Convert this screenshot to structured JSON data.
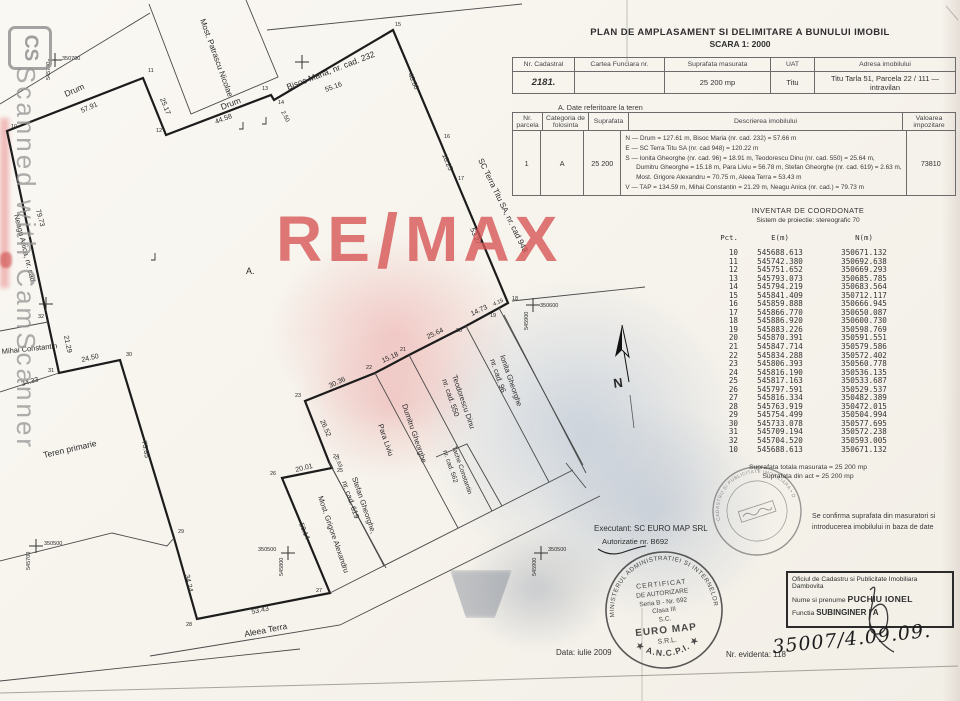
{
  "watermarks": {
    "cs_logo": "CS",
    "camscanner_text": "Scanned with CamScanner",
    "remax_re": "RE",
    "remax_slash": "/",
    "remax_max": "MAX"
  },
  "title": {
    "line1": "PLAN DE AMPLASAMENT SI DELIMITARE A BUNULUI IMOBIL",
    "line2": "SCARA 1: 2000"
  },
  "table1": {
    "headers": [
      "Nr. Cadastral",
      "Cartea Funciara nr.",
      "Suprafata masurata",
      "UAT",
      "Adresa imobilului"
    ],
    "row": {
      "nr_cadastral": "2181.",
      "cartea_funciara": "",
      "suprafata": "25 200 mp",
      "uat": "Titu",
      "adresa": "Titu Tarla 51, Parcela 22 / 111 — intravilan"
    }
  },
  "section_a": "A. Date referitoare la teren",
  "table2": {
    "headers": [
      "Nr. parcela",
      "Categoria de folosinta",
      "Suprafata",
      "Descrierea imobilului",
      "Valoarea impozitare"
    ],
    "row": {
      "nr": "1",
      "categorie": "A",
      "suprafata": "25 200",
      "descriere": [
        "N — Drum = 127.61 m, Bisoc Maria (nr. cad. 232) = 57.66 m",
        "E — SC Terra Titu SA (nr. cad 948) = 120.22 m",
        "S — Ionita Gheorghe (nr. cad. 96) = 18.91 m, Teodorescu Dinu (nr. cad. 550) = 25.64 m,",
        "      Dumitru Gheorghe = 15.18 m, Para Liviu = 56.78 m, Stefan Gheorghe (nr. cad. 619) = 2.63 m,",
        "      Most. Grigore Alexandru = 70.75 m, Aleea Terra = 53.43 m",
        "V — TAP = 134.59 m, Mihai Constantin = 21.29 m, Neagu Anica (nr. cad.) = 79.73 m"
      ],
      "valoare": "73810"
    }
  },
  "coords": {
    "title": "INVENTAR DE COORDONATE",
    "subtitle": "Sistem de proiectie: stereografic 70",
    "col_pct": "Pct.",
    "col_e": "E(m)",
    "col_n": "N(m)",
    "rows": [
      [
        "10",
        "545688.613",
        "350671.132"
      ],
      [
        "11",
        "545742.380",
        "350692.638"
      ],
      [
        "12",
        "545751.652",
        "350669.293"
      ],
      [
        "13",
        "545793.073",
        "350685.785"
      ],
      [
        "14",
        "545794.219",
        "350683.564"
      ],
      [
        "15",
        "545841.409",
        "350712.117"
      ],
      [
        "16",
        "545859.888",
        "350666.945"
      ],
      [
        "17",
        "545866.770",
        "350650.087"
      ],
      [
        "18",
        "545886.920",
        "350600.730"
      ],
      [
        "19",
        "545883.226",
        "350598.769"
      ],
      [
        "20",
        "545870.391",
        "350591.551"
      ],
      [
        "21",
        "545847.714",
        "350579.586"
      ],
      [
        "22",
        "545834.288",
        "350572.402"
      ],
      [
        "23",
        "545806.393",
        "350560.778"
      ],
      [
        "24",
        "545816.190",
        "350536.135"
      ],
      [
        "25",
        "545817.163",
        "350533.687"
      ],
      [
        "26",
        "545797.591",
        "350529.537"
      ],
      [
        "27",
        "545816.334",
        "350482.389"
      ],
      [
        "28",
        "545763.919",
        "350472.015"
      ],
      [
        "29",
        "545754.499",
        "350504.994"
      ],
      [
        "30",
        "545733.078",
        "350577.695"
      ],
      [
        "31",
        "545709.194",
        "350572.238"
      ],
      [
        "32",
        "545704.520",
        "350593.005"
      ],
      [
        "10",
        "545688.613",
        "350671.132"
      ]
    ],
    "total1": "Suprafata totala masurata = 25 200 mp",
    "total2": "Suprafata din act = 25 200 mp"
  },
  "plan": {
    "labels": [
      {
        "t": "Drum",
        "x": 66,
        "y": 97,
        "r": -24,
        "s": 8.5
      },
      {
        "t": "57.91",
        "x": 82,
        "y": 113,
        "r": -24,
        "s": 7
      },
      {
        "t": "25.17",
        "x": 160,
        "y": 99,
        "r": 68,
        "s": 7
      },
      {
        "t": "Drum",
        "x": 222,
        "y": 110,
        "r": -21,
        "s": 8.5
      },
      {
        "t": "44.58",
        "x": 216,
        "y": 124,
        "r": -21,
        "s": 7
      },
      {
        "t": "2.50",
        "x": 281,
        "y": 112,
        "r": 62,
        "s": 6
      },
      {
        "t": "Most. Patrascu Nicolae",
        "x": 200,
        "y": 20,
        "r": 70,
        "s": 8
      },
      {
        "t": "Bisoc Maria, nr. cad. 232",
        "x": 288,
        "y": 90,
        "r": -21,
        "s": 8.5
      },
      {
        "t": "55.16",
        "x": 326,
        "y": 92,
        "r": -21,
        "s": 7
      },
      {
        "t": "48.80",
        "x": 408,
        "y": 74,
        "r": 67,
        "s": 7
      },
      {
        "t": "18.25",
        "x": 442,
        "y": 155,
        "r": 67,
        "s": 7
      },
      {
        "t": "53.27",
        "x": 470,
        "y": 229,
        "r": 67,
        "s": 7
      },
      {
        "t": "SC Terra Titu SA, nr. cad 948",
        "x": 478,
        "y": 160,
        "r": 64,
        "s": 8
      },
      {
        "t": "4.15",
        "x": 494,
        "y": 306,
        "r": -25,
        "s": 5.5
      },
      {
        "t": "14.73",
        "x": 472,
        "y": 316,
        "r": -25,
        "s": 7
      },
      {
        "t": "25.64",
        "x": 428,
        "y": 339,
        "r": -25,
        "s": 7
      },
      {
        "t": "15.18",
        "x": 383,
        "y": 363,
        "r": -25,
        "s": 7
      },
      {
        "t": "30.36",
        "x": 330,
        "y": 388,
        "r": -25,
        "s": 7
      },
      {
        "t": "26.52",
        "x": 320,
        "y": 421,
        "r": 66,
        "s": 7
      },
      {
        "t": "2.63",
        "x": 335,
        "y": 458,
        "r": 66,
        "s": 5.5
      },
      {
        "t": "20.01",
        "x": 296,
        "y": 472,
        "r": -14,
        "s": 7
      },
      {
        "t": "50.14",
        "x": 299,
        "y": 524,
        "r": 67,
        "s": 7
      },
      {
        "t": "53.43",
        "x": 252,
        "y": 614,
        "r": -12,
        "s": 7
      },
      {
        "t": "34.24",
        "x": 185,
        "y": 575,
        "r": 78,
        "s": 7
      },
      {
        "t": "75.85",
        "x": 142,
        "y": 441,
        "r": 80,
        "s": 7
      },
      {
        "t": "24.50",
        "x": 82,
        "y": 362,
        "r": -13,
        "s": 7
      },
      {
        "t": "21.29",
        "x": 64,
        "y": 336,
        "r": 78,
        "s": 7
      },
      {
        "t": "79.73",
        "x": 36,
        "y": 210,
        "r": 75,
        "s": 7
      },
      {
        "t": "34.33",
        "x": 22,
        "y": 386,
        "r": -16,
        "s": 7
      },
      {
        "t": "Neagu Anica, nr. cad.",
        "x": 14,
        "y": 215,
        "r": 76,
        "s": 7.5
      },
      {
        "t": "Mihai Constantin",
        "x": 2,
        "y": 354,
        "r": -6,
        "s": 7.5
      },
      {
        "t": "Teren primarie",
        "x": 44,
        "y": 458,
        "r": -13,
        "s": 8.5
      },
      {
        "t": "Aleea Terra",
        "x": 245,
        "y": 637,
        "r": -11,
        "s": 8.5
      },
      {
        "t": "Most. Grigore Alexandru",
        "x": 318,
        "y": 497,
        "r": 71,
        "s": 7.5
      },
      {
        "t": "Stefan Gheorghe,",
        "x": 352,
        "y": 478,
        "r": 71,
        "s": 7.5
      },
      {
        "t": "nr. cad. 619",
        "x": 342,
        "y": 482,
        "r": 71,
        "s": 7.5
      },
      {
        "t": "Para Liviu",
        "x": 378,
        "y": 425,
        "r": 71,
        "s": 7.5
      },
      {
        "t": "Dumitru Gheorghe",
        "x": 402,
        "y": 405,
        "r": 71,
        "s": 7.5
      },
      {
        "t": "Teodorescu Dinu",
        "x": 452,
        "y": 376,
        "r": 71,
        "s": 7.5
      },
      {
        "t": "nr. cad. 550",
        "x": 442,
        "y": 380,
        "r": 71,
        "s": 7.5
      },
      {
        "t": "Ionita Gheorghe",
        "x": 500,
        "y": 356,
        "r": 71,
        "s": 7.5
      },
      {
        "t": "nr. cad. 96",
        "x": 490,
        "y": 360,
        "r": 71,
        "s": 7.5
      },
      {
        "t": "Tache Constantin",
        "x": 452,
        "y": 447,
        "r": 71,
        "s": 6.5
      },
      {
        "t": "nr. cad. 562",
        "x": 443,
        "y": 451,
        "r": 71,
        "s": 6.5
      },
      {
        "t": "A.",
        "x": 246,
        "y": 274,
        "r": 0,
        "s": 9
      },
      {
        "t": "N",
        "x": 614,
        "y": 388,
        "r": -8,
        "s": 13,
        "b": 1
      },
      {
        "t": "350700",
        "x": 62,
        "y": 60,
        "r": 0,
        "s": 5.5
      },
      {
        "t": "545700",
        "x": 50,
        "y": 80,
        "r": -90,
        "s": 5.5
      },
      {
        "t": "350600",
        "x": 540,
        "y": 307,
        "r": 0,
        "s": 5.5
      },
      {
        "t": "545900",
        "x": 528,
        "y": 330,
        "r": -90,
        "s": 5.5
      },
      {
        "t": "350500",
        "x": 258,
        "y": 551,
        "r": 0,
        "s": 5.5
      },
      {
        "t": "545800",
        "x": 283,
        "y": 576,
        "r": -90,
        "s": 5.5
      },
      {
        "t": "350500",
        "x": 548,
        "y": 551,
        "r": 0,
        "s": 5.5
      },
      {
        "t": "545900",
        "x": 536,
        "y": 576,
        "r": -90,
        "s": 5.5
      },
      {
        "t": "350500",
        "x": 44,
        "y": 545,
        "r": 0,
        "s": 5.5
      },
      {
        "t": "545700",
        "x": 30,
        "y": 570,
        "r": -90,
        "s": 5.5
      }
    ],
    "points": [
      {
        "n": "10",
        "x": 11,
        "y": 128
      },
      {
        "n": "11",
        "x": 148,
        "y": 72
      },
      {
        "n": "12",
        "x": 156,
        "y": 132
      },
      {
        "n": "13",
        "x": 262,
        "y": 90
      },
      {
        "n": "14",
        "x": 278,
        "y": 104
      },
      {
        "n": "15",
        "x": 395,
        "y": 26
      },
      {
        "n": "16",
        "x": 444,
        "y": 138
      },
      {
        "n": "17",
        "x": 458,
        "y": 180
      },
      {
        "n": "18",
        "x": 512,
        "y": 300
      },
      {
        "n": "19",
        "x": 490,
        "y": 317
      },
      {
        "n": "20",
        "x": 456,
        "y": 332
      },
      {
        "n": "21",
        "x": 400,
        "y": 351
      },
      {
        "n": "22",
        "x": 366,
        "y": 369
      },
      {
        "n": "23",
        "x": 295,
        "y": 397
      },
      {
        "n": "24",
        "x": 333,
        "y": 458
      },
      {
        "n": "25",
        "x": 337,
        "y": 472
      },
      {
        "n": "26",
        "x": 270,
        "y": 475
      },
      {
        "n": "27",
        "x": 316,
        "y": 592
      },
      {
        "n": "28",
        "x": 186,
        "y": 626
      },
      {
        "n": "29",
        "x": 178,
        "y": 533
      },
      {
        "n": "30",
        "x": 126,
        "y": 356
      },
      {
        "n": "31",
        "x": 48,
        "y": 372
      },
      {
        "n": "32",
        "x": 38,
        "y": 318
      }
    ]
  },
  "executant": {
    "line1": "Executant: SC EURO MAP SRL",
    "line2": "Autorizatie nr. B692"
  },
  "stamp_cert": {
    "ring_top": "MINISTERUL ADMINISTRATIEI SI INTERNELOR",
    "ring_bottom": "★ A.N.C.P.I. ★",
    "lines": [
      "CERTIFICAT",
      "DE AUTORIZARE",
      "Seria B - Nr. 692",
      "Clasa III",
      "S.C.",
      "EURO MAP",
      "S.R.L."
    ]
  },
  "stamp_round": {
    "ring": "OFICIUL DE CADASTRU SI PUBLICITATE IMOBILIARA • DAMBOVITA •"
  },
  "confirm": {
    "text1": "Se confirma suprafata din masuratori si",
    "text2": "introducerea imobilului in baza de date",
    "box_line1": "Oficiul de Cadastru si Publicitate Imobiliara Dambovita",
    "box_line2_label": "Nume si prenume",
    "box_line2_value": "PUCHIU IONEL",
    "box_line3_label": "Functia",
    "box_line3_value": "SUBINGINER I A",
    "handwritten": "35007/4.09.09."
  },
  "footer": {
    "data": "Data: iulie 2009",
    "evidenta": "Nr. evidenta: 118"
  }
}
